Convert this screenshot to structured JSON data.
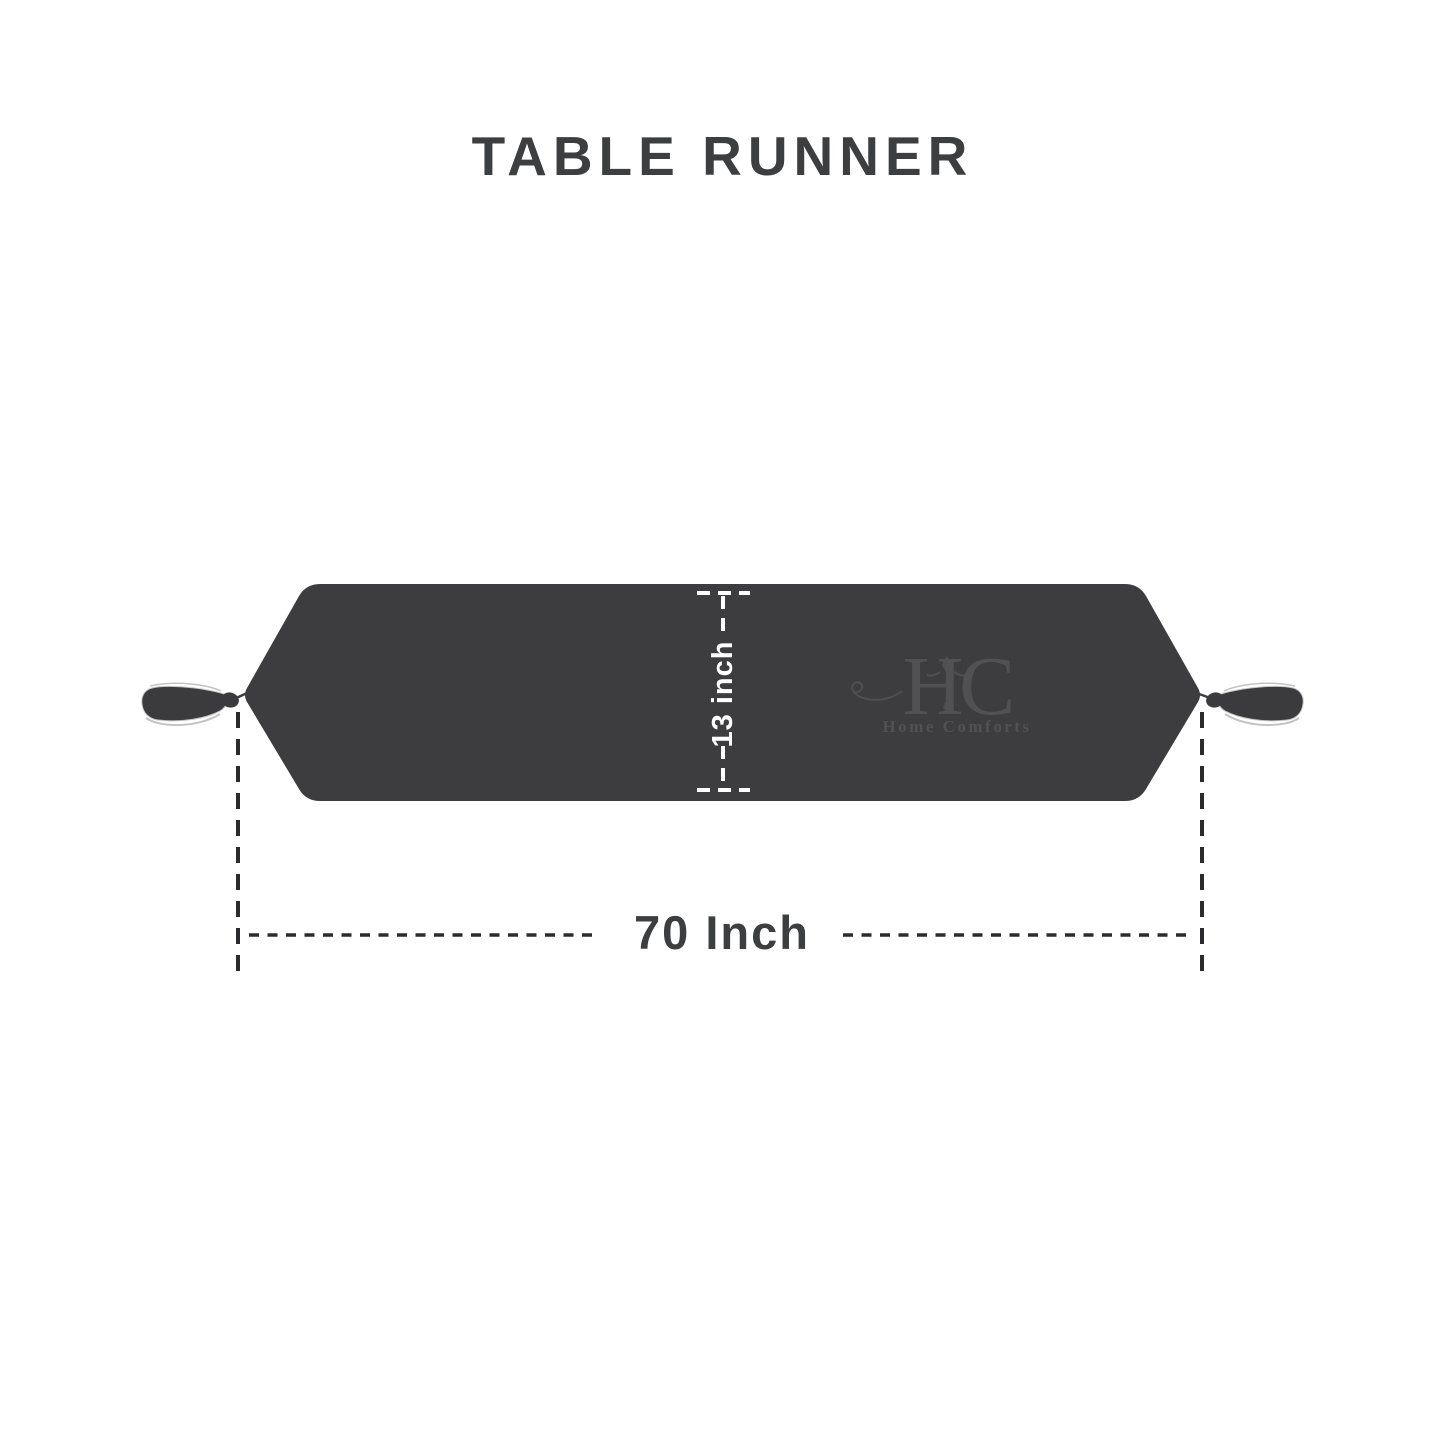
{
  "title": {
    "text": "TABLE RUNNER"
  },
  "dimensions": {
    "height_label": "13 inch",
    "width_label": "70 Inch"
  },
  "watermark": {
    "monogram": "HC",
    "name": "Home Comforts"
  },
  "colors": {
    "background": "#ffffff",
    "runner_fill": "#3d3d3f",
    "text_dark": "#3d3e40",
    "dimension_dash_dark": "#2b2b2d",
    "dimension_dash_white": "#ffffff",
    "tassel_outline": "#c3c3c3",
    "watermark_gray": "#515154"
  }
}
